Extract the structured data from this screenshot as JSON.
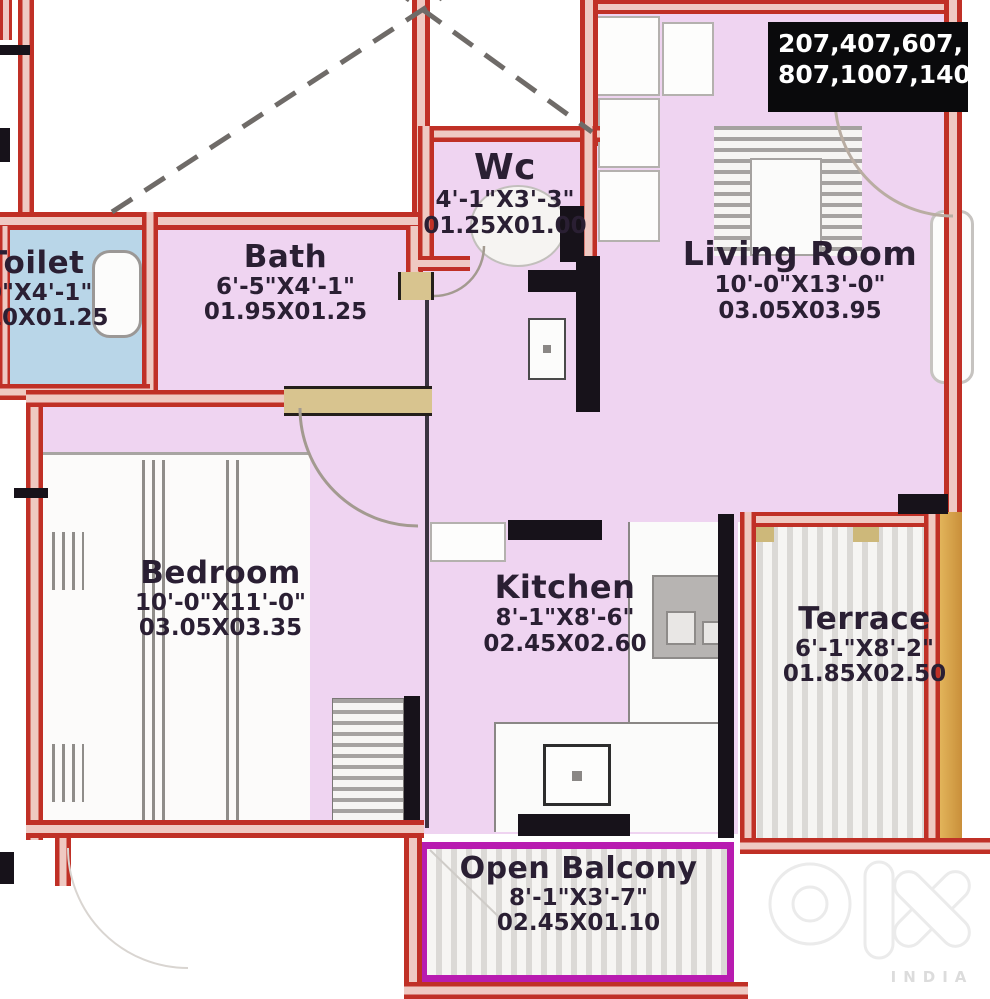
{
  "plan": {
    "unit_list": {
      "line1": "207,407,607,",
      "line2": "807,1007,1407"
    },
    "rooms": [
      {
        "id": "toilet",
        "name": "Toilet",
        "dim_ft": "0\"X4'-1\"",
        "dim_m": "10X01.25"
      },
      {
        "id": "bath",
        "name": "Bath",
        "dim_ft": "6'-5\"X4'-1\"",
        "dim_m": "01.95X01.25"
      },
      {
        "id": "wc",
        "name": "Wc",
        "dim_ft": "4'-1\"X3'-3\"",
        "dim_m": "01.25X01.00"
      },
      {
        "id": "living",
        "name": "Living Room",
        "dim_ft": "10'-0\"X13'-0\"",
        "dim_m": "03.05X03.95"
      },
      {
        "id": "bedroom",
        "name": "Bedroom",
        "dim_ft": "10'-0\"X11'-0\"",
        "dim_m": "03.05X03.35"
      },
      {
        "id": "kitchen",
        "name": "Kitchen",
        "dim_ft": "8'-1\"X8'-6\"",
        "dim_m": "02.45X02.60"
      },
      {
        "id": "terrace",
        "name": "Terrace",
        "dim_ft": "6'-1\"X8'-2\"",
        "dim_m": "01.85X02.50"
      },
      {
        "id": "balcony",
        "name": "Open Balcony",
        "dim_ft": "8'-1\"X3'-7\"",
        "dim_m": "02.45X01.10"
      }
    ],
    "watermark": {
      "brand": "olx",
      "country": "INDIA"
    }
  },
  "colors": {
    "wall_red": "#c03026",
    "wall_black": "#17121a",
    "floor_pink": "#efd4f1",
    "floor_blue": "#b9d6e8",
    "balcony_border": "#b81bb0",
    "door_tan": "#d8c48f",
    "terrace_outer": "#d2a04c",
    "info_box_bg": "#0a0a0c"
  }
}
